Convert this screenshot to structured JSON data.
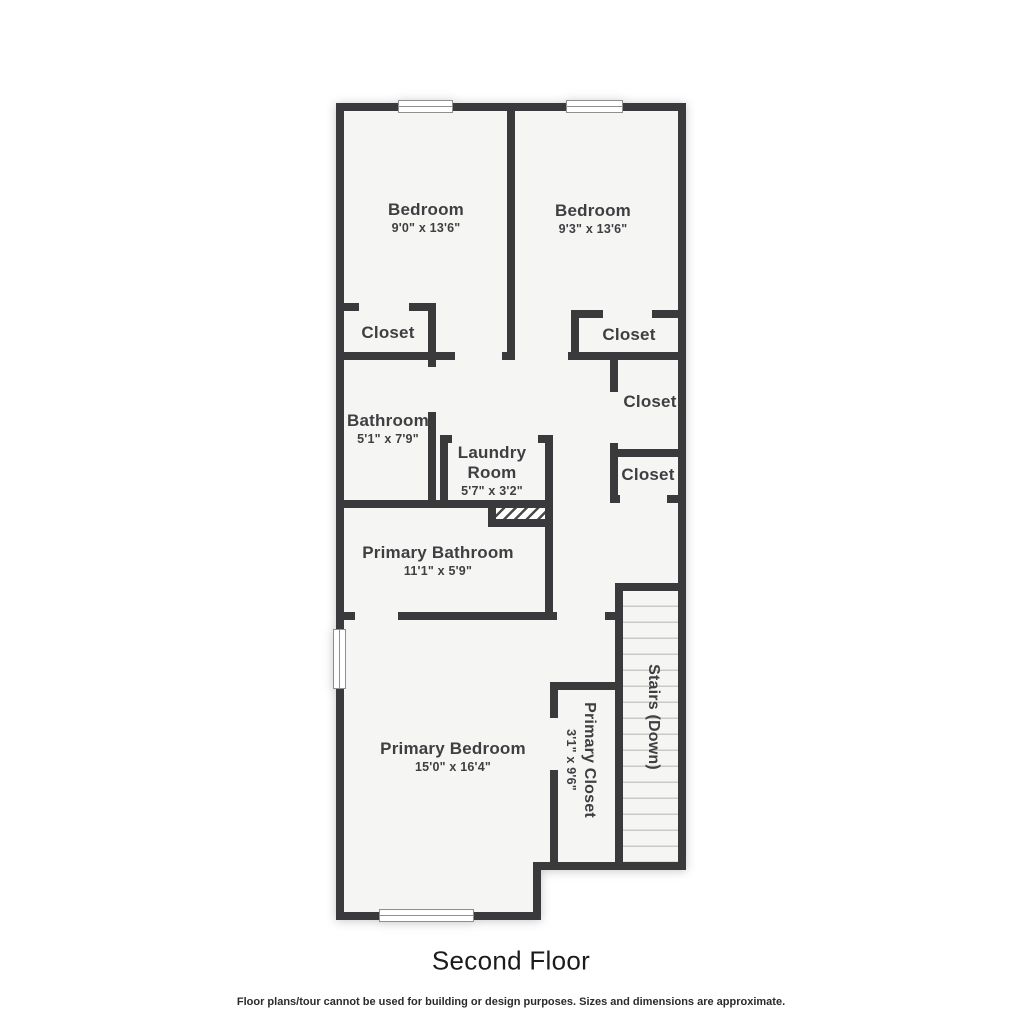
{
  "floor_plan": {
    "title": "Second Floor",
    "disclaimer": "Floor plans/tour cannot be used for building or design purposes. Sizes and dimensions are approximate.",
    "rooms": {
      "bedroom_left": {
        "name": "Bedroom",
        "dims": "9'0\" x 13'6\""
      },
      "bedroom_right": {
        "name": "Bedroom",
        "dims": "9'3\" x 13'6\""
      },
      "closet_bedroom_left": {
        "name": "Closet"
      },
      "closet_bedroom_right": {
        "name": "Closet"
      },
      "bathroom": {
        "name": "Bathroom",
        "dims": "5'1\" x 7'9\""
      },
      "laundry_room": {
        "name": "Laundry Room",
        "dims": "5'7\" x 3'2\""
      },
      "hall_closet_upper": {
        "name": "Closet"
      },
      "hall_closet_lower": {
        "name": "Closet"
      },
      "primary_bathroom": {
        "name": "Primary Bathroom",
        "dims": "11'1\" x 5'9\""
      },
      "primary_bedroom": {
        "name": "Primary Bedroom",
        "dims": "15'0\" x 16'4\""
      },
      "primary_closet": {
        "name": "Primary Closet",
        "dims": "3'1\" x 9'6\""
      },
      "stairs": {
        "name": "Stairs (Down)"
      }
    },
    "colors": {
      "wall": "#3a3a3c",
      "room_fill": "#f5f5f4",
      "background": "#ffffff",
      "label": "#3e3f41",
      "tread_line": "#c9c9c9"
    }
  }
}
